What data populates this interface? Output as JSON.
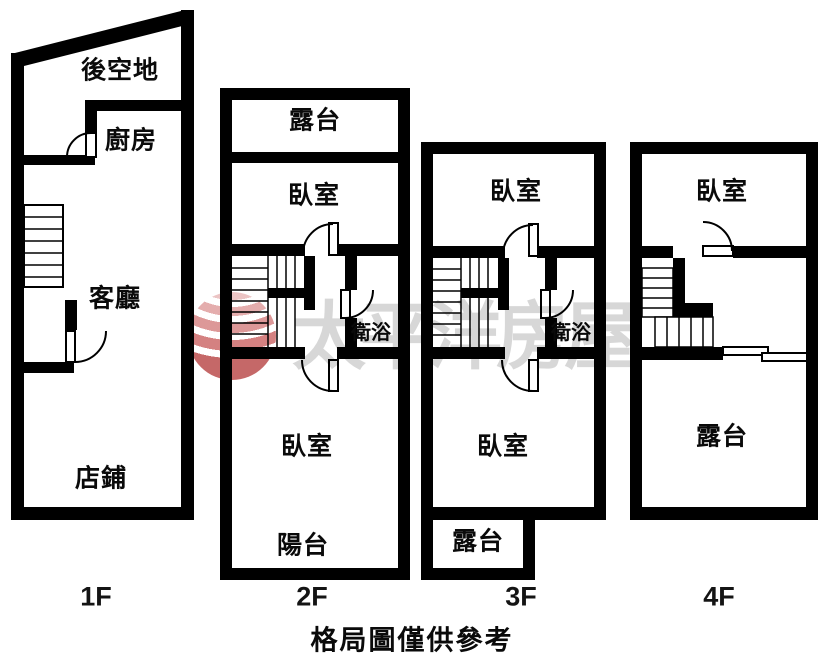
{
  "caption": "格局圖僅供參考",
  "watermark": {
    "brand": "太平洋房屋"
  },
  "floors": [
    {
      "label": "1F",
      "rooms": [
        "後空地",
        "廚房",
        "客廳",
        "店鋪"
      ]
    },
    {
      "label": "2F",
      "rooms": [
        "露台",
        "臥室",
        "衛浴",
        "臥室",
        "陽台"
      ]
    },
    {
      "label": "3F",
      "rooms": [
        "臥室",
        "衛浴",
        "臥室",
        "露台"
      ]
    },
    {
      "label": "4F",
      "rooms": [
        "臥室",
        "露台"
      ]
    }
  ]
}
